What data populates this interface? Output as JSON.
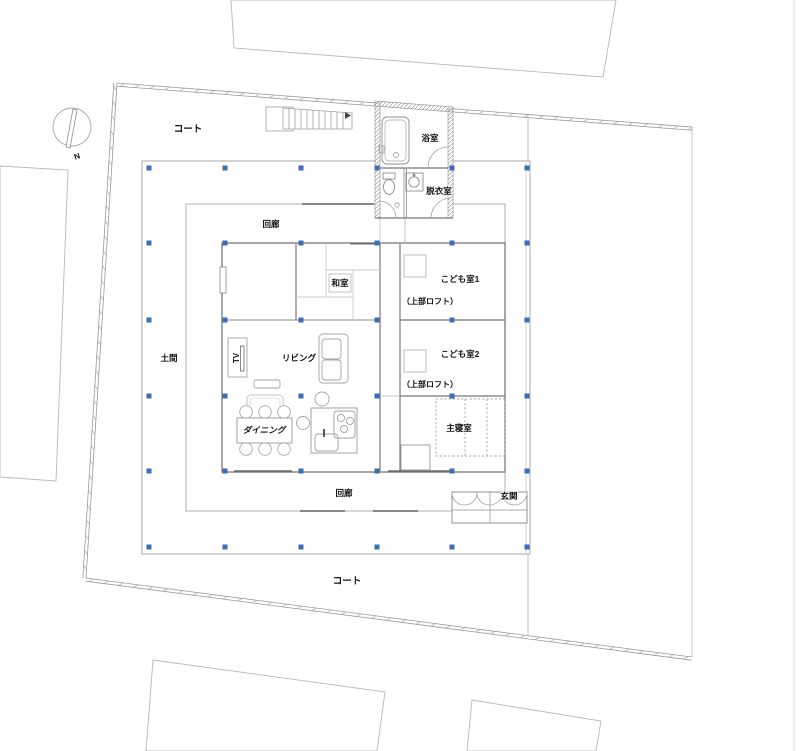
{
  "drawing": {
    "type": "architectural floor plan",
    "compass": {
      "north_label": "N"
    },
    "site_labels": {
      "court_top": "コート",
      "court_bottom": "コート"
    },
    "rooms": {
      "corridor_top": "回廊",
      "corridor_bottom": "回廊",
      "bath": "浴室",
      "dressing": "脱衣室",
      "tatami": "和室",
      "kids1": "こども室1",
      "kids1_loft": "（上部ロフト）",
      "kids2": "こども室2",
      "kids2_loft": "（上部ロフト）",
      "living": "リビング",
      "dining": "ダイニング",
      "doma": "土間",
      "master_bedroom": "主寝室",
      "entrance": "玄関",
      "tv": "TV"
    },
    "colors": {
      "column": "#3a6eb5",
      "line_light": "#9a9a9a",
      "wall": "#6e6e6e",
      "text": "#111111"
    },
    "structure": {
      "column_grid_x": [
        149,
        225,
        301,
        377,
        452,
        527
      ],
      "column_grid_y": [
        168,
        243,
        320,
        396,
        471,
        547
      ],
      "column_size": 5
    }
  }
}
